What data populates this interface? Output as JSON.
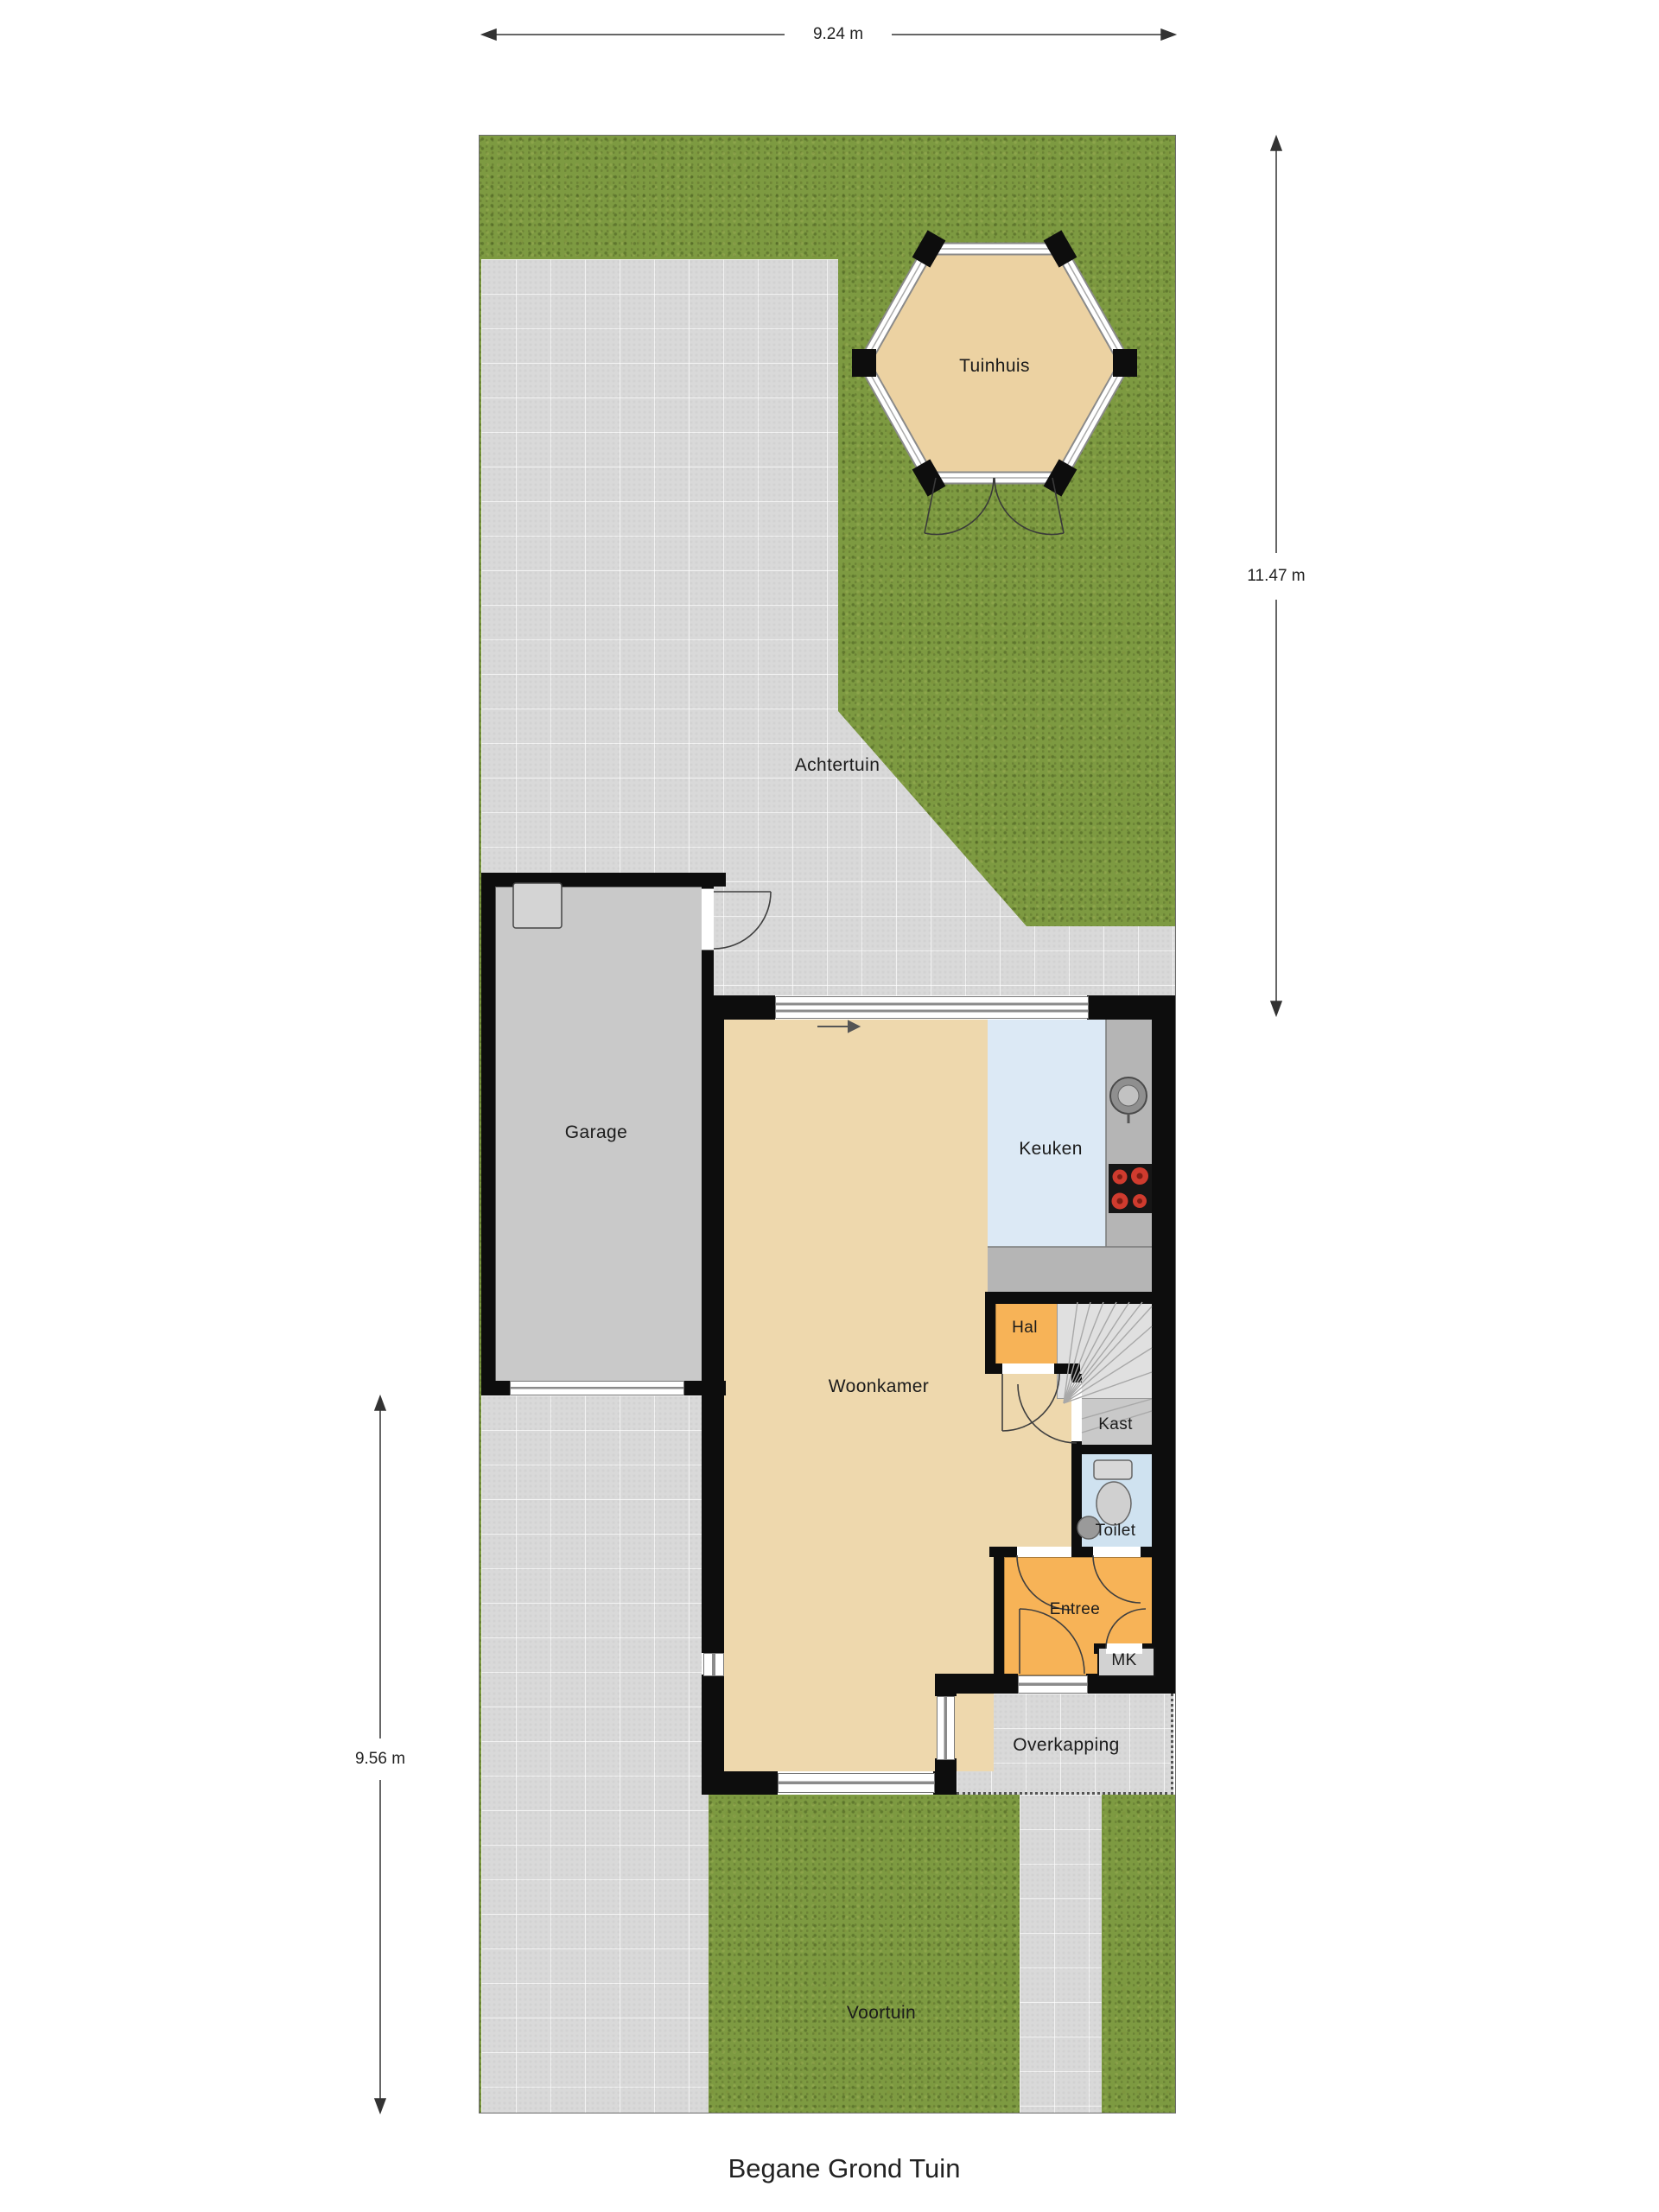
{
  "title": "Begane Grond Tuin",
  "dimensions": {
    "width_top": "9.24 m",
    "height_right": "11.47 m",
    "height_left": "9.56 m"
  },
  "rooms": {
    "tuinhuis": "Tuinhuis",
    "achtertuin": "Achtertuin",
    "garage": "Garage",
    "keuken": "Keuken",
    "woonkamer": "Woonkamer",
    "hal": "Hal",
    "kast": "Kast",
    "toilet": "Toilet",
    "entree": "Entree",
    "mk": "MK",
    "overkapping": "Overkapping",
    "voortuin": "Voortuin"
  },
  "colors": {
    "grass": "#7d9a41",
    "paving": "#d9d9d9",
    "wall": "#0d0d0d",
    "floor_living": "#eed8ad",
    "floor_kitchen": "#dce9f5",
    "floor_toilet": "#cfe2f0",
    "floor_hall_orange": "#f7b357",
    "floor_garage": "#c9c9c9",
    "stairs": "#e0e0e0",
    "counter": "#b5b5b5",
    "burner_red": "#cf3b2e"
  }
}
